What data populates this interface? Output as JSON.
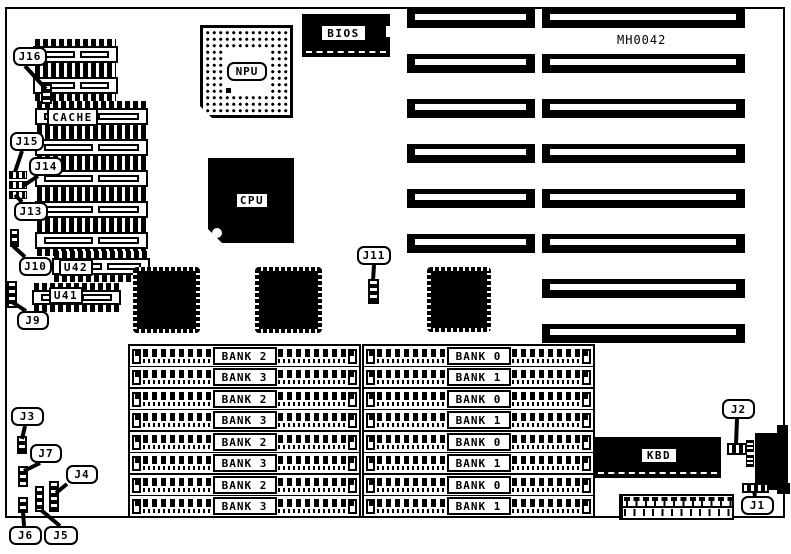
{
  "board": {
    "model": "MH0042"
  },
  "chips": {
    "cache": "CACHE",
    "npu": "NPU",
    "cpu": "CPU",
    "bios": "BIOS",
    "kbd": "KBD",
    "u41": "U41",
    "u42": "U42"
  },
  "jumpers": {
    "j1": "J1",
    "j2": "J2",
    "j3": "J3",
    "j4": "J4",
    "j5": "J5",
    "j6": "J6",
    "j7": "J7",
    "j9": "J9",
    "j10": "J10",
    "j11": "J11",
    "j13": "J13",
    "j14": "J14",
    "j15": "J15",
    "j16": "J16"
  },
  "memory": {
    "left_bank_labels": [
      "BANK 2",
      "BANK 3",
      "BANK 2",
      "BANK 3",
      "BANK 2",
      "BANK 3",
      "BANK 2",
      "BANK 3"
    ],
    "right_bank_labels": [
      "BANK 0",
      "BANK 1",
      "BANK 0",
      "BANK 1",
      "BANK 0",
      "BANK 1",
      "BANK 0",
      "BANK 1"
    ]
  },
  "colors": {
    "ink": "#000000",
    "paper": "#ffffff"
  }
}
